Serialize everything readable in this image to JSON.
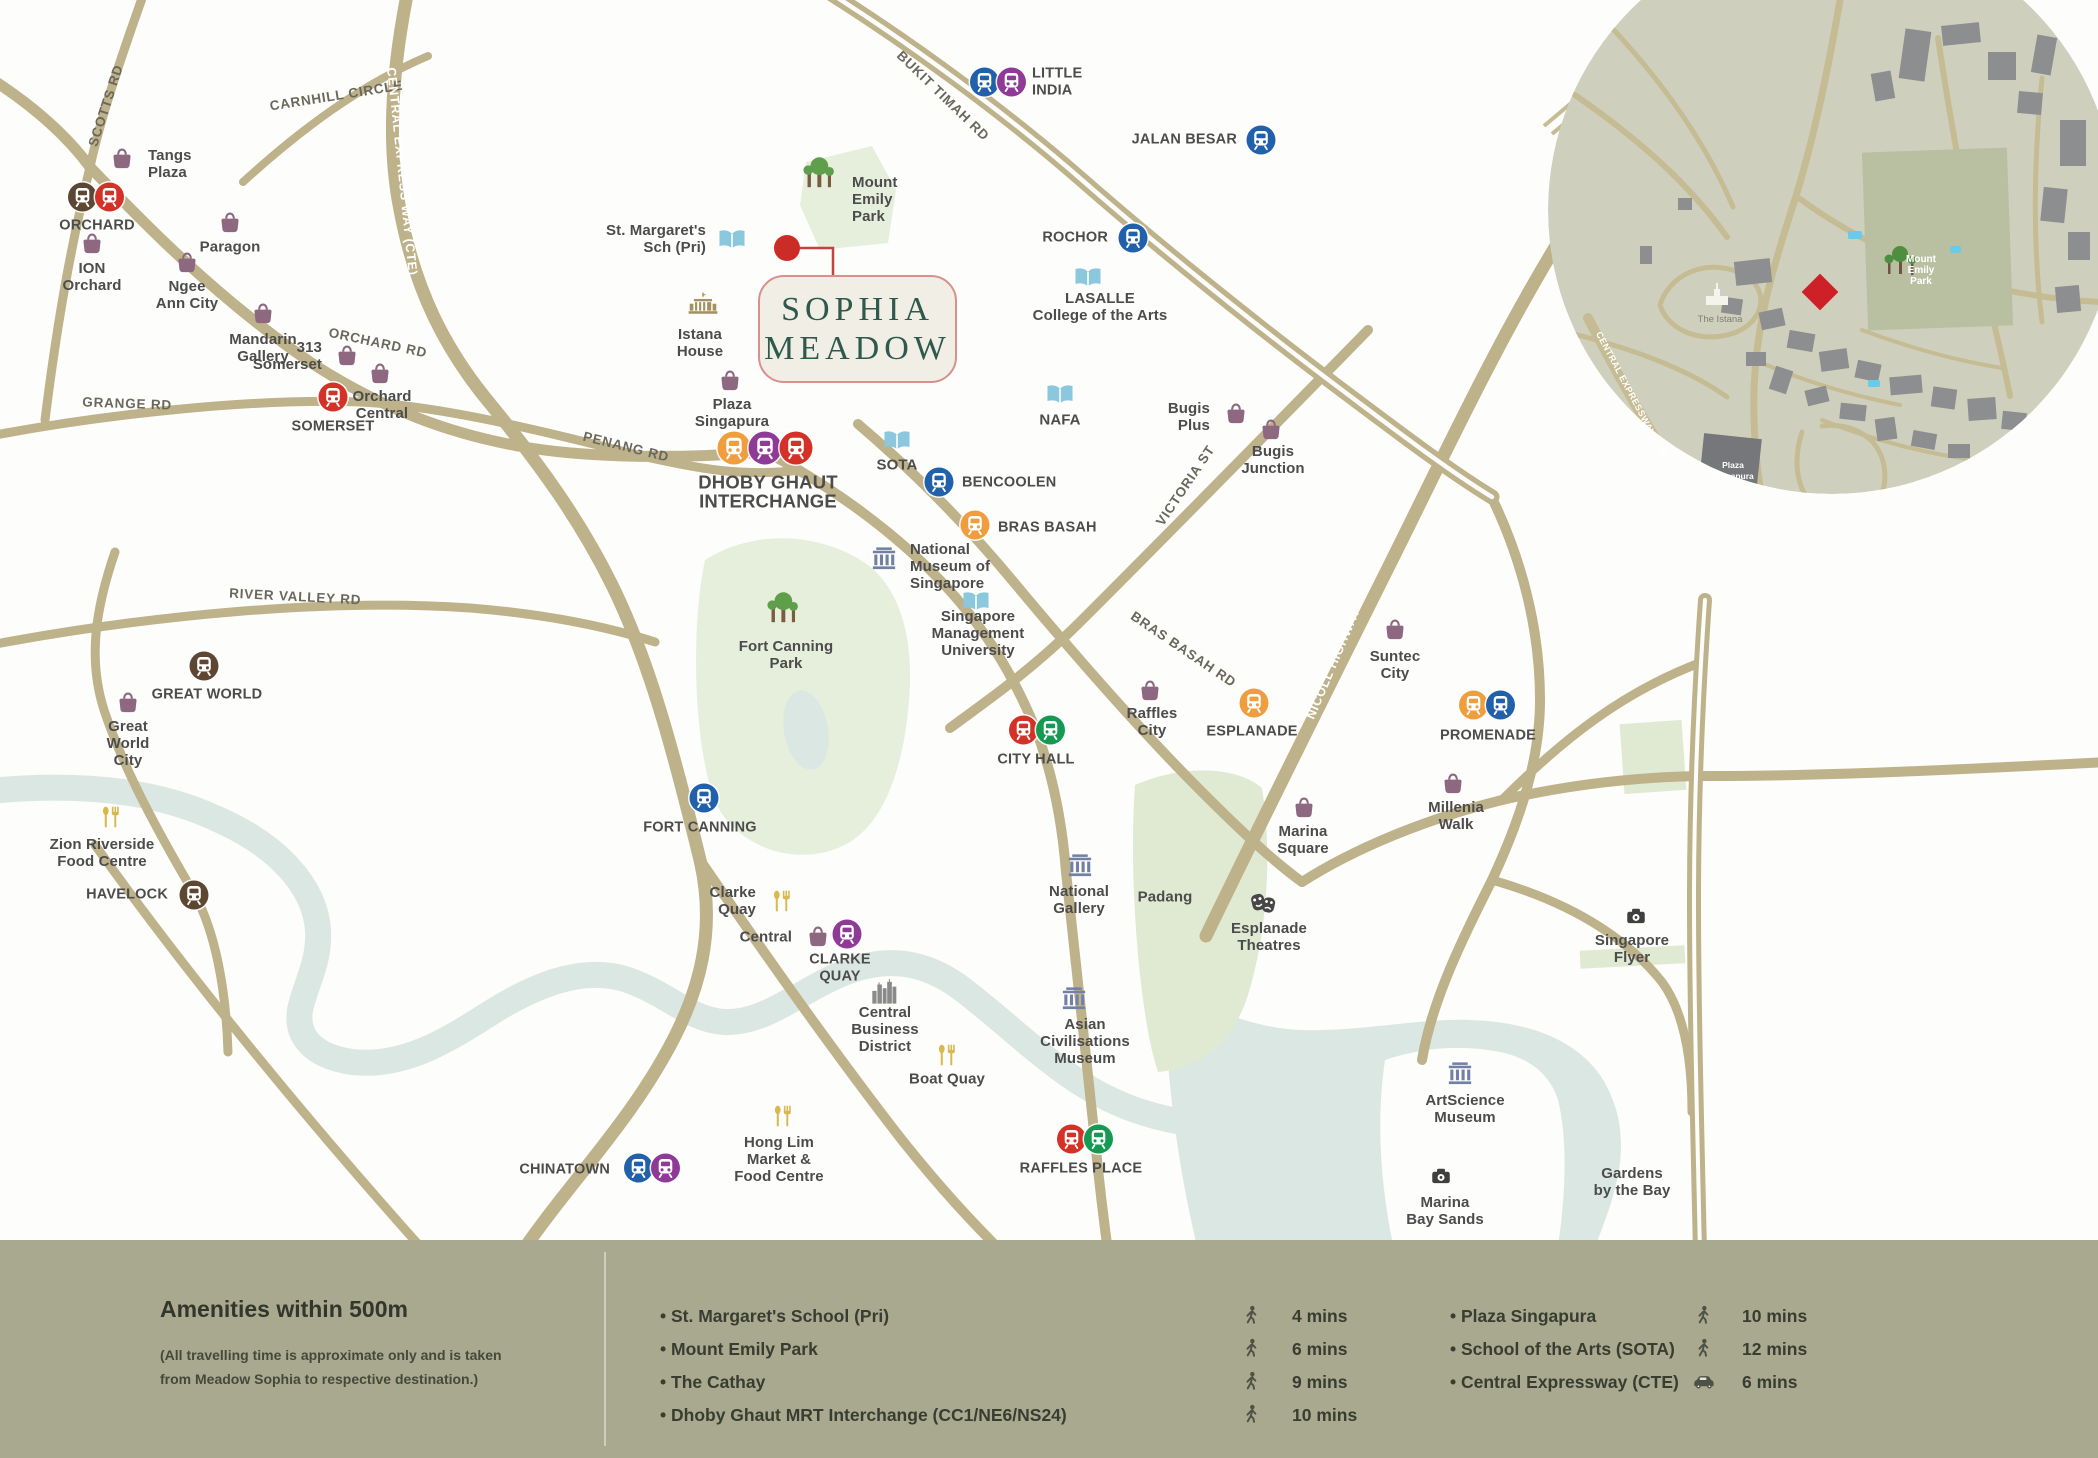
{
  "project": {
    "name_line1": "SOPHIA",
    "name_line2": "MEADOW"
  },
  "colors": {
    "accent_red": "#cb2d26",
    "panel_bg": "#a8a98f",
    "road": "#beb28a",
    "water": "#dbe7e3",
    "park": "#e6efdc",
    "project_green": "#2e594c",
    "label_gray": "#4c4c4c",
    "lines": {
      "NS": "#d43127",
      "EW": "#159a52",
      "NE": "#8f3a97",
      "CC": "#f09e3d",
      "DT": "#2160ab",
      "TE": "#5d4733"
    },
    "icons": {
      "bag": "#8d6880",
      "book": "#8bc8dd",
      "museum": "#7380a6",
      "food": "#d8b94f",
      "masks": "#474747",
      "camera": "#3f3f3f",
      "palace": "#a5905f",
      "skyline": "#8a8a8a",
      "tree": "#5f9e4b",
      "trunk": "#7a5c3e",
      "legend": "#4e5246"
    }
  },
  "map": {
    "road_labels": [
      {
        "id": "scotts-rd",
        "t": "SCOTTS RD",
        "x": 110,
        "y": 107,
        "r": -72
      },
      {
        "id": "carnhill-circle",
        "t": "CARNHILL CIRCLE",
        "x": 337,
        "y": 100,
        "r": -9
      },
      {
        "id": "central-expressway",
        "t": "CENTRAL EXPRESS WAY (CTE)",
        "x": 398,
        "y": 172,
        "r": 84,
        "w": true
      },
      {
        "id": "orchard-rd",
        "t": "ORCHARD RD",
        "x": 377,
        "y": 347,
        "r": 12
      },
      {
        "id": "grange-rd",
        "t": "GRANGE RD",
        "x": 127,
        "y": 408,
        "r": 2
      },
      {
        "id": "penang-rd",
        "t": "PENANG RD",
        "x": 625,
        "y": 451,
        "r": 14
      },
      {
        "id": "river-valley-rd",
        "t": "RIVER VALLEY RD",
        "x": 295,
        "y": 601,
        "r": 3
      },
      {
        "id": "bukit-timah-rd",
        "t": "BUKIT TIMAH RD",
        "x": 940,
        "y": 99,
        "r": 44
      },
      {
        "id": "victoria-st",
        "t": "VICTORIA ST",
        "x": 1189,
        "y": 488,
        "r": -56
      },
      {
        "id": "bras-basah-rd",
        "t": "BRAS BASAH RD",
        "x": 1181,
        "y": 653,
        "r": 34
      },
      {
        "id": "nicoll-highway",
        "t": "NICOLL HIGHWAY",
        "x": 1337,
        "y": 665,
        "r": -67,
        "w": true
      }
    ],
    "places": [
      {
        "id": "tangs-plaza",
        "icon": "bag",
        "x": 122,
        "y": 158,
        "lx": 148,
        "ly": 165,
        "al": "r",
        "lines": [
          "Tangs",
          "Plaza"
        ]
      },
      {
        "id": "ion-orchard",
        "icon": "bag",
        "x": 92,
        "y": 243,
        "lx": 92,
        "ly": 278,
        "al": "c",
        "lines": [
          "ION",
          "Orchard"
        ]
      },
      {
        "id": "paragon",
        "icon": "bag",
        "x": 230,
        "y": 222,
        "lx": 230,
        "ly": 248,
        "al": "c",
        "lines": [
          "Paragon"
        ]
      },
      {
        "id": "ngee-ann-city",
        "icon": "bag",
        "x": 187,
        "y": 262,
        "lx": 187,
        "ly": 296,
        "al": "c",
        "lines": [
          "Ngee",
          "Ann City"
        ]
      },
      {
        "id": "mandarin-gallery",
        "icon": "bag",
        "x": 263,
        "y": 313,
        "lx": 263,
        "ly": 349,
        "al": "c",
        "lines": [
          "Mandarin",
          "Gallery"
        ]
      },
      {
        "id": "313-somerset",
        "icon": "bag",
        "x": 347,
        "y": 355,
        "lx": 322,
        "ly": 357,
        "al": "l",
        "lines": [
          "313",
          "Somerset"
        ]
      },
      {
        "id": "orchard-central",
        "icon": "bag",
        "x": 380,
        "y": 373,
        "lx": 382,
        "ly": 406,
        "al": "c",
        "lines": [
          "Orchard",
          "Central"
        ]
      },
      {
        "id": "plaza-singapura",
        "icon": "bag",
        "x": 730,
        "y": 380,
        "lx": 732,
        "ly": 414,
        "al": "c",
        "lines": [
          "Plaza",
          "Singapura"
        ]
      },
      {
        "id": "istana-house",
        "icon": "palace",
        "x": 703,
        "y": 308,
        "lx": 700,
        "ly": 344,
        "al": "c",
        "lines": [
          "Istana",
          "House"
        ]
      },
      {
        "id": "st-margarets-sch",
        "icon": "book",
        "x": 732,
        "y": 240,
        "lx": 706,
        "ly": 240,
        "al": "l",
        "lines": [
          "St. Margaret's",
          "Sch (Pri)"
        ]
      },
      {
        "id": "mount-emily-park",
        "icon": "trees",
        "x": 820,
        "y": 178,
        "lx": 852,
        "ly": 200,
        "al": "r",
        "lines": [
          "Mount",
          "Emily",
          "Park"
        ]
      },
      {
        "id": "lasalle",
        "icon": "book",
        "x": 1088,
        "y": 278,
        "lx": 1100,
        "ly": 308,
        "al": "c",
        "lines": [
          "LASALLE",
          "College of the Arts"
        ]
      },
      {
        "id": "nafa",
        "icon": "book",
        "x": 1060,
        "y": 395,
        "lx": 1060,
        "ly": 421,
        "al": "c",
        "lines": [
          "NAFA"
        ]
      },
      {
        "id": "sota",
        "icon": "book",
        "x": 897,
        "y": 441,
        "lx": 897,
        "ly": 466,
        "al": "c",
        "lines": [
          "SOTA"
        ]
      },
      {
        "id": "smu",
        "icon": "book",
        "x": 976,
        "y": 602,
        "lx": 978,
        "ly": 634,
        "al": "c",
        "lines": [
          "Singapore",
          "Management",
          "University"
        ]
      },
      {
        "id": "national-museum",
        "icon": "museum",
        "x": 884,
        "y": 560,
        "lx": 910,
        "ly": 567,
        "al": "r",
        "lines": [
          "National",
          "Museum of",
          "Singapore"
        ]
      },
      {
        "id": "fort-canning-park",
        "icon": "trees",
        "x": 784,
        "y": 613,
        "lx": 786,
        "ly": 656,
        "al": "c",
        "lines": [
          "Fort Canning",
          "Park"
        ]
      },
      {
        "id": "bugis-plus",
        "icon": "bag",
        "x": 1236,
        "y": 413,
        "lx": 1210,
        "ly": 418,
        "al": "l",
        "lines": [
          "Bugis",
          "Plus"
        ]
      },
      {
        "id": "bugis-junction",
        "icon": "bag",
        "x": 1271,
        "y": 429,
        "lx": 1273,
        "ly": 461,
        "al": "c",
        "lines": [
          "Bugis",
          "Junction"
        ]
      },
      {
        "id": "raffles-city",
        "icon": "bag",
        "x": 1150,
        "y": 690,
        "lx": 1152,
        "ly": 723,
        "al": "c",
        "lines": [
          "Raffles",
          "City"
        ]
      },
      {
        "id": "suntec-city",
        "icon": "bag",
        "x": 1395,
        "y": 629,
        "lx": 1395,
        "ly": 666,
        "al": "c",
        "lines": [
          "Suntec",
          "City"
        ]
      },
      {
        "id": "marina-square",
        "icon": "bag",
        "x": 1304,
        "y": 807,
        "lx": 1303,
        "ly": 841,
        "al": "c",
        "lines": [
          "Marina",
          "Square"
        ]
      },
      {
        "id": "millenia-walk",
        "icon": "bag",
        "x": 1453,
        "y": 783,
        "lx": 1456,
        "ly": 817,
        "al": "c",
        "lines": [
          "Millenia",
          "Walk"
        ]
      },
      {
        "id": "great-world-city",
        "icon": "bag",
        "x": 128,
        "y": 702,
        "lx": 128,
        "ly": 744,
        "al": "c",
        "lines": [
          "Great",
          "World",
          "City"
        ]
      },
      {
        "id": "zion-riverside",
        "icon": "food",
        "x": 110,
        "y": 818,
        "lx": 102,
        "ly": 854,
        "al": "c",
        "lines": [
          "Zion Riverside",
          "Food Centre"
        ]
      },
      {
        "id": "clarke-quay-food",
        "icon": "food",
        "x": 781,
        "y": 902,
        "lx": 756,
        "ly": 902,
        "al": "l",
        "lines": [
          "Clarke",
          "Quay"
        ]
      },
      {
        "id": "central-mall",
        "icon": "bag",
        "x": 818,
        "y": 936,
        "lx": 792,
        "ly": 938,
        "al": "l",
        "lines": [
          "Central"
        ]
      },
      {
        "id": "central-business-district",
        "icon": "skyline",
        "x": 884,
        "y": 993,
        "lx": 885,
        "ly": 1030,
        "al": "c",
        "lines": [
          "Central",
          "Business",
          "District"
        ]
      },
      {
        "id": "boat-quay",
        "icon": "food",
        "x": 946,
        "y": 1056,
        "lx": 947,
        "ly": 1080,
        "al": "c",
        "lines": [
          "Boat Quay"
        ]
      },
      {
        "id": "hong-lim",
        "icon": "food",
        "x": 782,
        "y": 1117,
        "lx": 779,
        "ly": 1160,
        "al": "c",
        "lines": [
          "Hong Lim",
          "Market &",
          "Food Centre"
        ]
      },
      {
        "id": "national-gallery",
        "icon": "museum",
        "x": 1080,
        "y": 867,
        "lx": 1079,
        "ly": 901,
        "al": "c",
        "lines": [
          "National",
          "Gallery"
        ]
      },
      {
        "id": "esplanade-theatres",
        "icon": "masks",
        "x": 1263,
        "y": 904,
        "lx": 1269,
        "ly": 938,
        "al": "c",
        "lines": [
          "Esplanade",
          "Theatres"
        ]
      },
      {
        "id": "asian-civilisations-museum",
        "icon": "museum",
        "x": 1074,
        "y": 1000,
        "lx": 1085,
        "ly": 1042,
        "al": "c",
        "lines": [
          "Asian",
          "Civilisations",
          "Museum"
        ]
      },
      {
        "id": "artscience-museum",
        "icon": "museum",
        "x": 1460,
        "y": 1075,
        "lx": 1465,
        "ly": 1110,
        "al": "c",
        "lines": [
          "ArtScience",
          "Museum"
        ]
      },
      {
        "id": "marina-bay-sands",
        "icon": "camera",
        "x": 1441,
        "y": 1177,
        "lx": 1445,
        "ly": 1212,
        "al": "c",
        "lines": [
          "Marina",
          "Bay Sands"
        ]
      },
      {
        "id": "singapore-flyer",
        "icon": "camera",
        "x": 1636,
        "y": 917,
        "lx": 1632,
        "ly": 950,
        "al": "c",
        "lines": [
          "Singapore",
          "Flyer"
        ]
      },
      {
        "id": "gardens-by-the-bay",
        "icon": "none",
        "x": 1632,
        "y": 1183,
        "lx": 1632,
        "ly": 1183,
        "al": "c",
        "lines": [
          "Gardens",
          "by the Bay"
        ]
      },
      {
        "id": "padang",
        "icon": "none",
        "x": 1165,
        "y": 898,
        "lx": 1165,
        "ly": 898,
        "al": "c",
        "lines": [
          "Padang"
        ]
      }
    ],
    "stations": [
      {
        "id": "orchard",
        "x": 95,
        "y": 197,
        "codes": [
          "TE",
          "NS"
        ],
        "lx": 97,
        "ly": 226,
        "al": "c",
        "lines": [
          "ORCHARD"
        ]
      },
      {
        "id": "somerset",
        "x": 332,
        "y": 397,
        "codes": [
          "NS"
        ],
        "lx": 333,
        "ly": 427,
        "al": "c",
        "lines": [
          "SOMERSET"
        ]
      },
      {
        "id": "dhoby-ghaut",
        "x": 764,
        "y": 448,
        "codes": [
          "CC",
          "NE",
          "NS"
        ],
        "lx": 768,
        "ly": 492,
        "al": "c",
        "lines": [
          "DHOBY GHAUT",
          "INTERCHANGE"
        ],
        "big": true
      },
      {
        "id": "little-india",
        "x": 997,
        "y": 82,
        "codes": [
          "DT",
          "NE"
        ],
        "lx": 1032,
        "ly": 82,
        "al": "r",
        "lines": [
          "LITTLE",
          "INDIA"
        ]
      },
      {
        "id": "jalan-besar",
        "x": 1260,
        "y": 140,
        "codes": [
          "DT"
        ],
        "lx": 1237,
        "ly": 140,
        "al": "l",
        "lines": [
          "JALAN BESAR"
        ]
      },
      {
        "id": "rochor",
        "x": 1132,
        "y": 238,
        "codes": [
          "DT"
        ],
        "lx": 1108,
        "ly": 238,
        "al": "l",
        "lines": [
          "ROCHOR"
        ]
      },
      {
        "id": "bencoolen",
        "x": 938,
        "y": 482,
        "codes": [
          "DT"
        ],
        "lx": 962,
        "ly": 483,
        "al": "r",
        "lines": [
          "BENCOOLEN"
        ]
      },
      {
        "id": "bras-basah",
        "x": 974,
        "y": 525,
        "codes": [
          "CC"
        ],
        "lx": 998,
        "ly": 528,
        "al": "r",
        "lines": [
          "BRAS BASAH"
        ]
      },
      {
        "id": "esplanade",
        "x": 1253,
        "y": 703,
        "codes": [
          "CC"
        ],
        "lx": 1252,
        "ly": 732,
        "al": "c",
        "lines": [
          "ESPLANADE"
        ]
      },
      {
        "id": "promenade",
        "x": 1486,
        "y": 705,
        "codes": [
          "CC",
          "DT"
        ],
        "lx": 1488,
        "ly": 736,
        "al": "c",
        "lines": [
          "PROMENADE"
        ]
      },
      {
        "id": "city-hall",
        "x": 1036,
        "y": 730,
        "codes": [
          "NS",
          "EW"
        ],
        "lx": 1036,
        "ly": 760,
        "al": "c",
        "lines": [
          "CITY HALL"
        ]
      },
      {
        "id": "raffles-place",
        "x": 1084,
        "y": 1139,
        "codes": [
          "NS",
          "EW"
        ],
        "lx": 1081,
        "ly": 1169,
        "al": "c",
        "lines": [
          "RAFFLES PLACE"
        ]
      },
      {
        "id": "clarke-quay",
        "x": 846,
        "y": 934,
        "codes": [
          "NE"
        ],
        "lx": 840,
        "ly": 968,
        "al": "c",
        "lines": [
          "CLARKE",
          "QUAY"
        ]
      },
      {
        "id": "fort-canning",
        "x": 703,
        "y": 798,
        "codes": [
          "DT"
        ],
        "lx": 700,
        "ly": 828,
        "al": "c",
        "lines": [
          "FORT CANNING"
        ]
      },
      {
        "id": "chinatown",
        "x": 651,
        "y": 1168,
        "codes": [
          "DT",
          "NE"
        ],
        "lx": 610,
        "ly": 1170,
        "al": "l",
        "lines": [
          "CHINATOWN"
        ]
      },
      {
        "id": "great-world",
        "x": 203,
        "y": 666,
        "codes": [
          "TE"
        ],
        "lx": 207,
        "ly": 695,
        "al": "c",
        "lines": [
          "GREAT WORLD"
        ]
      },
      {
        "id": "havelock",
        "x": 193,
        "y": 895,
        "codes": [
          "TE"
        ],
        "lx": 168,
        "ly": 895,
        "al": "l",
        "lines": [
          "HAVELOCK"
        ]
      }
    ]
  },
  "inset": {
    "labels": [
      {
        "id": "inset-mount-emily-park",
        "lines": [
          "Mount",
          "Emily",
          "Park"
        ],
        "x": 1921,
        "y": 262,
        "cls": "ins-white"
      },
      {
        "id": "inset-the-istana",
        "lines": [
          "The Istana"
        ],
        "x": 1720,
        "y": 322,
        "cls": "ins-gray"
      },
      {
        "id": "inset-central-expressway",
        "lines": [
          "CENTRAL EXPRESSWAY (CTE)"
        ],
        "x": 1630,
        "y": 398,
        "cls": "ins-white-rot",
        "rot": 62
      },
      {
        "id": "inset-plaza-singapura",
        "lines": [
          "Plaza",
          "Singapura"
        ],
        "x": 1733,
        "y": 468,
        "cls": "ins-white-sm"
      }
    ]
  },
  "panel": {
    "heading": "Amenities within 500m",
    "note_line1": "(All travelling time is approximate only and is taken",
    "note_line2": "from Meadow Sophia to respective destination.)",
    "list_left": [
      {
        "name": "St. Margaret's School (Pri)",
        "mode": "walk",
        "time": "4 mins"
      },
      {
        "name": "Mount Emily Park",
        "mode": "walk",
        "time": "6 mins"
      },
      {
        "name": "The Cathay",
        "mode": "walk",
        "time": "9 mins"
      },
      {
        "name": "Dhoby Ghaut MRT Interchange (CC1/NE6/NS24)",
        "mode": "walk",
        "time": "10 mins"
      }
    ],
    "list_right": [
      {
        "name": "Plaza Singapura",
        "mode": "walk",
        "time": "10 mins"
      },
      {
        "name": "School of the Arts (SOTA)",
        "mode": "walk",
        "time": "12 mins"
      },
      {
        "name": "Central Expressway (CTE)",
        "mode": "car",
        "time": "6 mins"
      }
    ]
  }
}
